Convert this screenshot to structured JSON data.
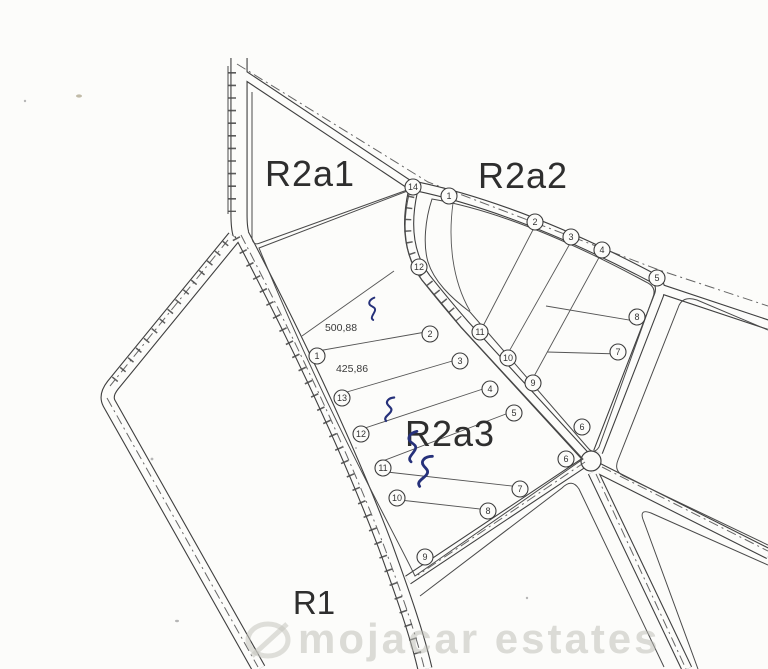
{
  "map": {
    "type": "cadastral-parcel-plan",
    "background": "#fcfcfa",
    "line_color": "#3f3f3f",
    "ink_color": "#26317a",
    "zone_labels": [
      {
        "id": "R2a1",
        "text": "R2a1",
        "x": 310,
        "y": 186
      },
      {
        "id": "R2a2",
        "text": "R2a2",
        "x": 523,
        "y": 188
      },
      {
        "id": "R2a3",
        "text": "R2a3",
        "x": 450,
        "y": 446
      },
      {
        "id": "R1",
        "text": "R1",
        "x": 314,
        "y": 614
      }
    ],
    "measurements": [
      {
        "text": "500,88",
        "x": 341,
        "y": 331
      },
      {
        "text": "425,86",
        "x": 352,
        "y": 372
      }
    ],
    "blocks": [
      {
        "name": "R2a2",
        "plots": [
          {
            "n": "1",
            "x": 449,
            "y": 196
          },
          {
            "n": "2",
            "x": 535,
            "y": 222
          },
          {
            "n": "3",
            "x": 571,
            "y": 237
          },
          {
            "n": "4",
            "x": 602,
            "y": 250
          },
          {
            "n": "5",
            "x": 657,
            "y": 278
          },
          {
            "n": "6",
            "x": 582,
            "y": 427
          },
          {
            "n": "7",
            "x": 618,
            "y": 352
          },
          {
            "n": "8",
            "x": 637,
            "y": 317
          },
          {
            "n": "9",
            "x": 533,
            "y": 383
          },
          {
            "n": "10",
            "x": 508,
            "y": 358
          },
          {
            "n": "11",
            "x": 480,
            "y": 332
          },
          {
            "n": "12",
            "x": 419,
            "y": 267
          }
        ]
      },
      {
        "name": "R2a3",
        "plots": [
          {
            "n": "1",
            "x": 317,
            "y": 356
          },
          {
            "n": "2",
            "x": 430,
            "y": 334
          },
          {
            "n": "3",
            "x": 460,
            "y": 361
          },
          {
            "n": "4",
            "x": 490,
            "y": 389
          },
          {
            "n": "5",
            "x": 514,
            "y": 413
          },
          {
            "n": "6",
            "x": 566,
            "y": 459
          },
          {
            "n": "7",
            "x": 520,
            "y": 489
          },
          {
            "n": "8",
            "x": 488,
            "y": 511
          },
          {
            "n": "9",
            "x": 425,
            "y": 557
          },
          {
            "n": "10",
            "x": 397,
            "y": 498
          },
          {
            "n": "11",
            "x": 383,
            "y": 468
          },
          {
            "n": "12",
            "x": 361,
            "y": 434
          },
          {
            "n": "13",
            "x": 342,
            "y": 398
          }
        ]
      },
      {
        "name": "junction",
        "plots": [
          {
            "n": "14",
            "x": 413,
            "y": 187
          }
        ]
      }
    ],
    "hand_marks": [
      {
        "x": 368,
        "y": 299
      },
      {
        "x": 387,
        "y": 397
      },
      {
        "x": 408,
        "y": 432
      },
      {
        "x": 423,
        "y": 455
      }
    ],
    "watermark": {
      "logo": "mojacar-estates-logo",
      "text": "mojacar estates",
      "color": "#b9b9b2"
    }
  }
}
